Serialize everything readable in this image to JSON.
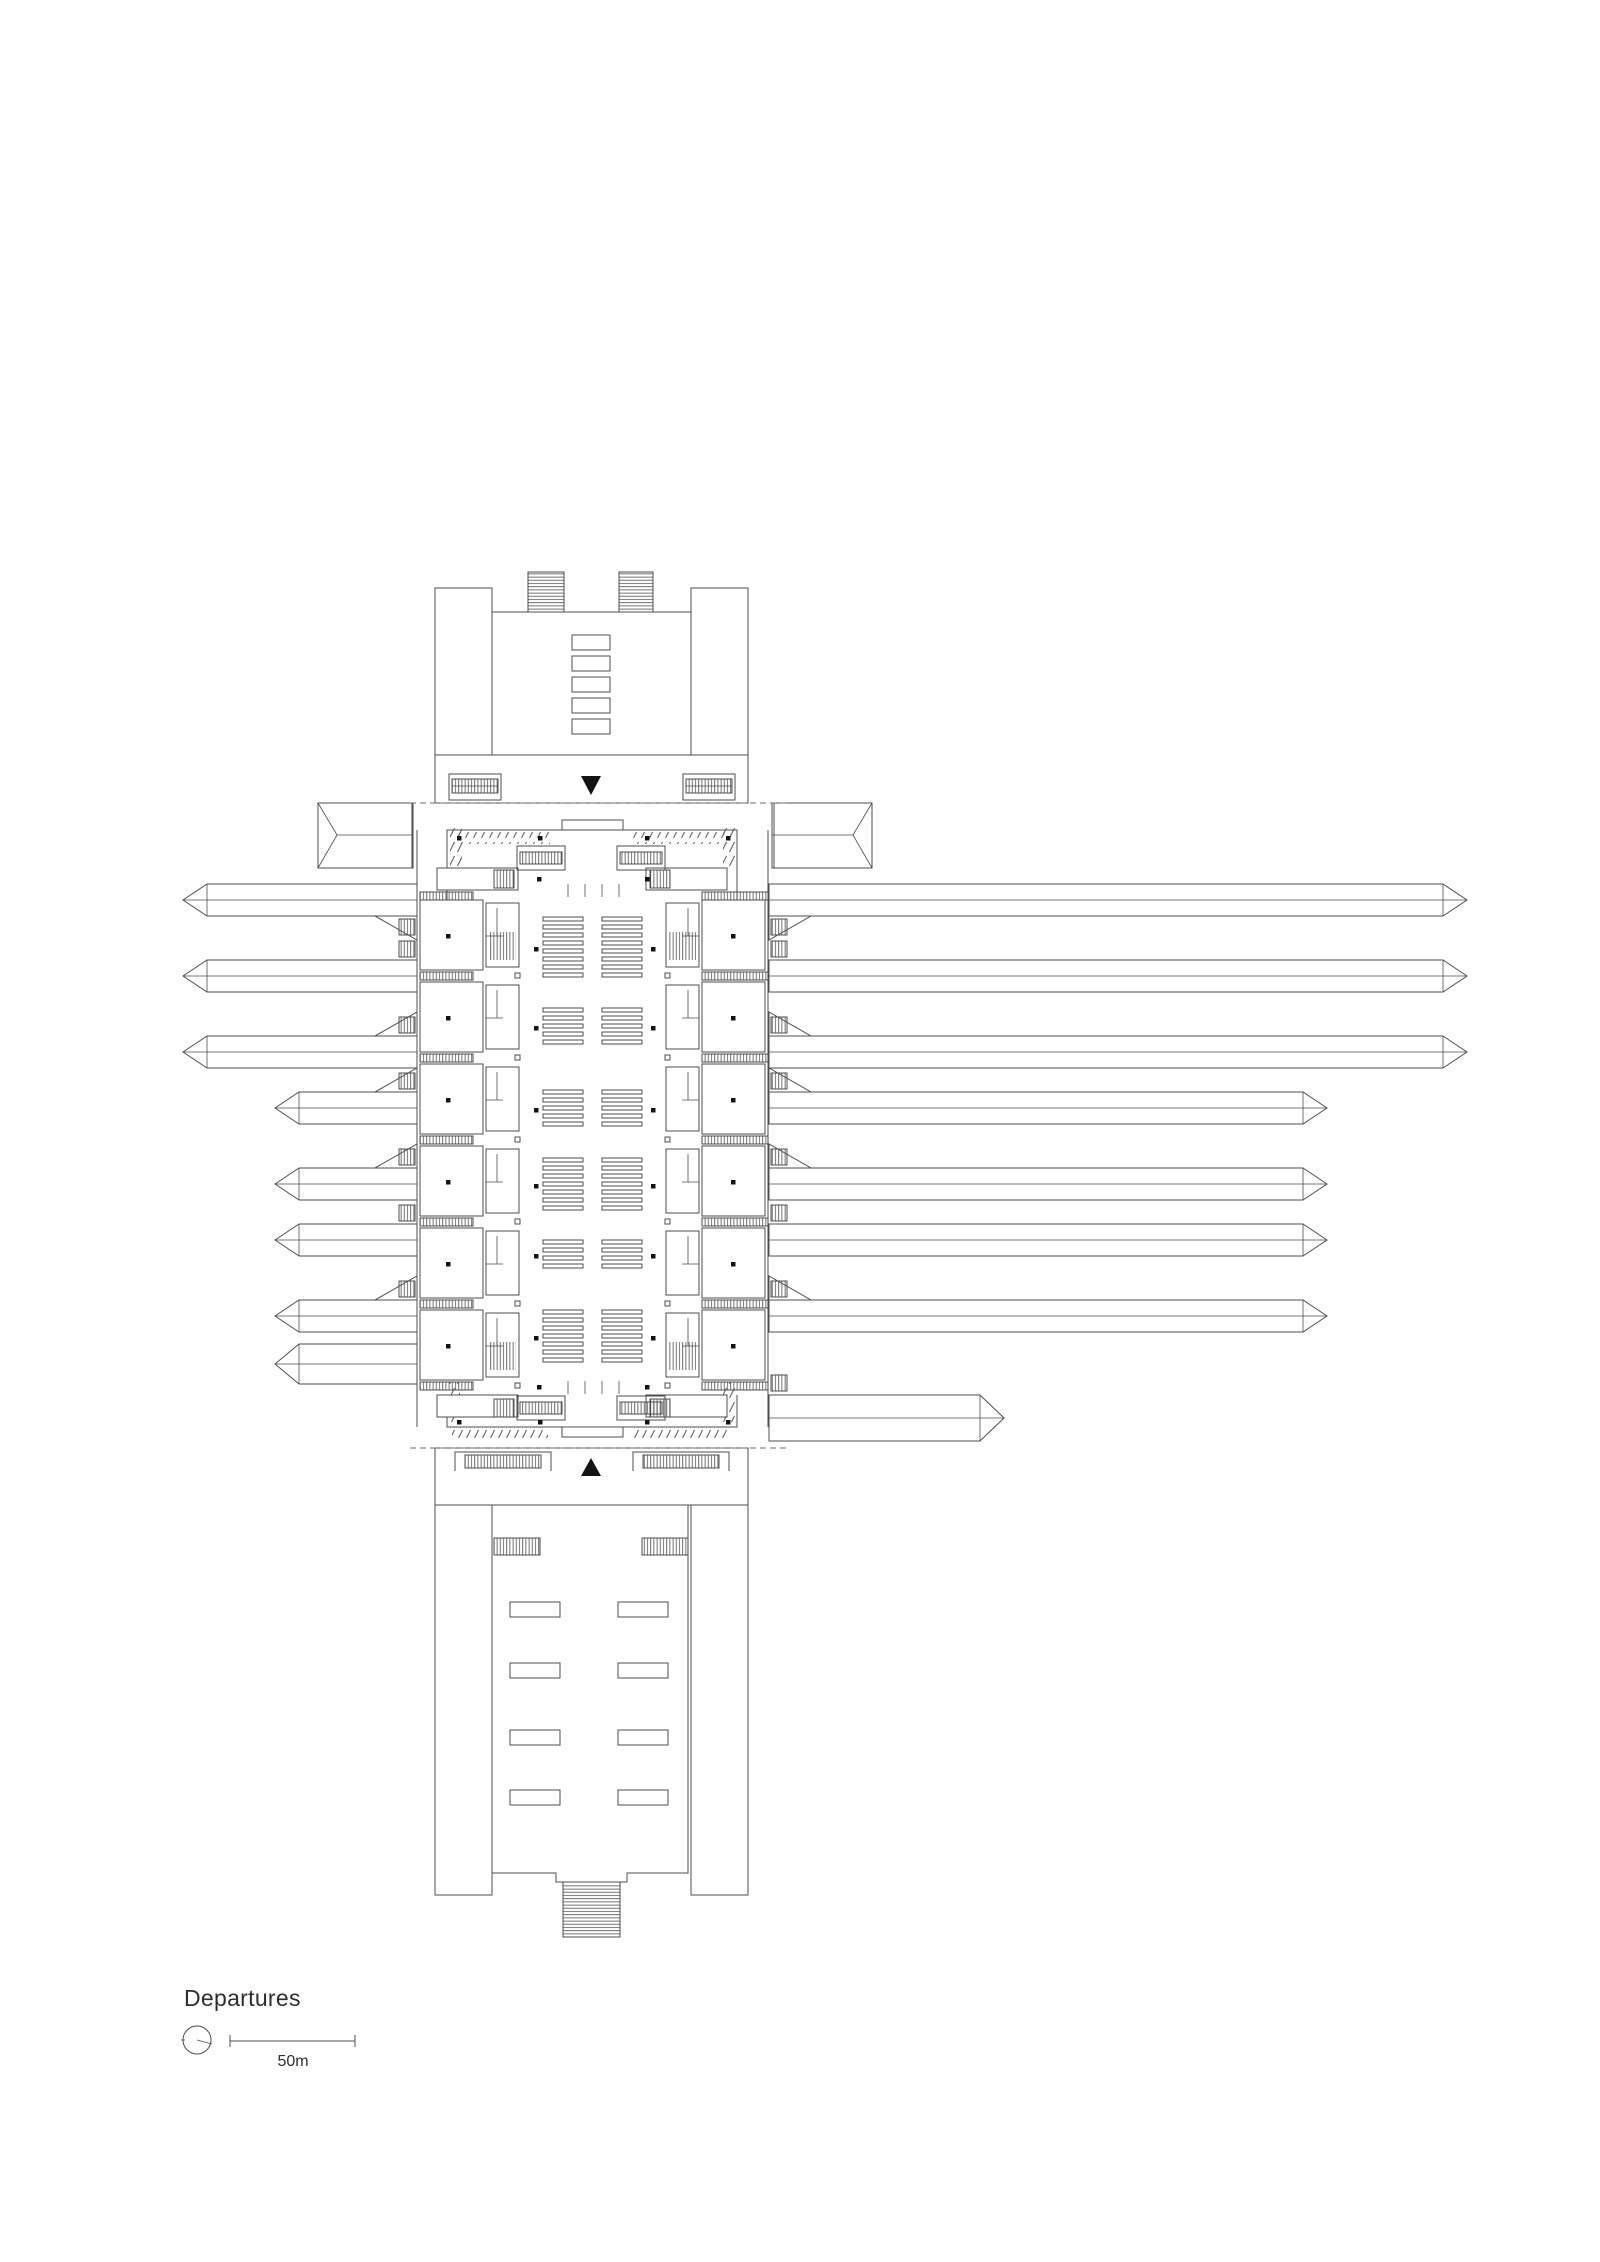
{
  "legend": {
    "title": "Departures",
    "scale_label": "50m"
  },
  "plan": {
    "drawing_type": "station floor plan",
    "level_shown": "Departures",
    "platforms_left": 8,
    "platforms_right": 8,
    "platform_stub_pairs": 1,
    "side_room_modules_per_side": 6,
    "bench_groups": 6,
    "direction_markers": [
      "triangle-down",
      "triangle-up"
    ],
    "line_color": "#4d4d4d",
    "marker_color": "#141414",
    "dashed_line_color": "#6e6e6e",
    "background_color": "#ffffff"
  }
}
